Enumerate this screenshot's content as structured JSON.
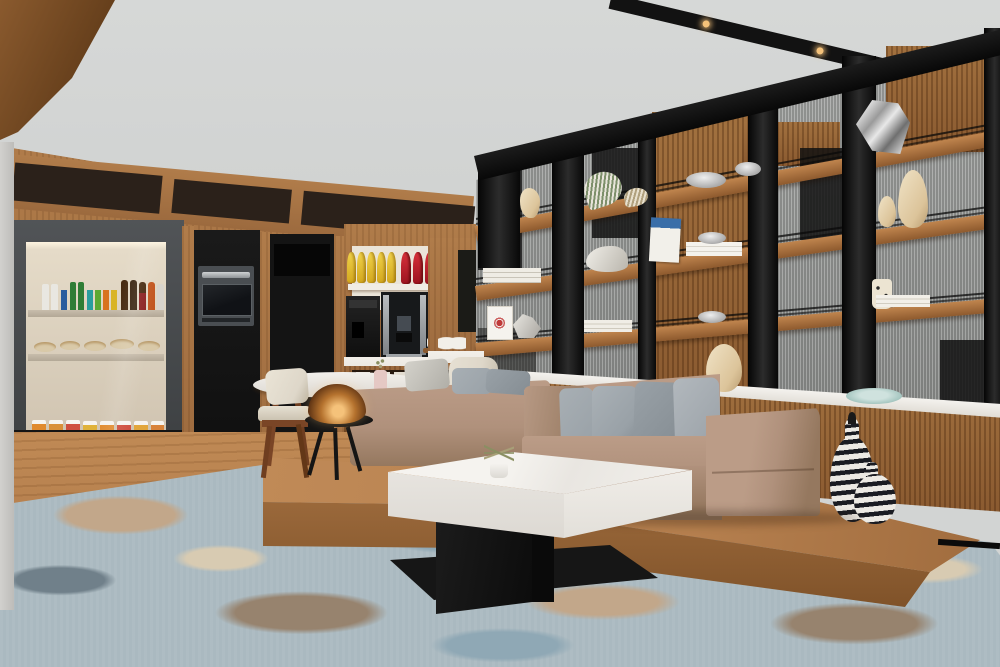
{
  "scene": {
    "title": "Hotel lounge pantry corner with snack display, coffee station, decorative shelving, tan sectional sofa, white marble coffee table and abstract blue rug",
    "room_type": "hotel lounge / pantry",
    "lighting": "soft daylight, warm recessed ceiling spots"
  },
  "palette": {
    "ceiling": "#d2d4d3",
    "beamBlack": "#121212",
    "lampGlow": "#f5c27a",
    "lampAmber": "#b5722e",
    "wood": "#9c6a3e",
    "woodLight": "#b07c4a",
    "woodDark": "#7a4e28",
    "woodSlat": "#a2713f",
    "woodSlatD": "#8a5a30",
    "floor": "#b07a4a",
    "floorLight": "#c08a55",
    "clerestory": "#2b211a",
    "panelBlack": "#141414",
    "caseFrame": "#46494b",
    "caseInner": "#d9cebd",
    "caseShelf": "#c7bcab",
    "counter": "#ece9e3",
    "marble": "#f1efeb",
    "marbleFace": "#e7e4df",
    "tableBlack": "#161616",
    "sofaTan": "#b0917c",
    "sofaTanDark": "#95785f",
    "pillow": "#99a1a7",
    "pillowDark": "#858d93",
    "cushionCream": "#ded7c9",
    "platform": "#b57f4e",
    "platformDark": "#9c6a3c",
    "rugBase": "#aab9c0",
    "rugBlue": "#8fa8b5",
    "rugSlate": "#70808a",
    "rugTan": "#c2a78a",
    "rugBrown": "#97836e",
    "rugCream": "#d8cbb2",
    "fluted": "#9fa19f",
    "chipsYellowL": "#f0d24a",
    "chipsYellow": "#d4a81e",
    "chipsRedL": "#d7303a",
    "chipsRed": "#9c1420",
    "snackGreen": "#7ea84a",
    "snackYellow": "#d9c23a",
    "snackBlue": "#2b72b8",
    "vaseCream": "#dcc49a",
    "vaseCreamL": "#f0e3c6",
    "stripeDark": "#1a1c22",
    "stripeLight": "#eceae4",
    "plateTeal": "#a5c6c0",
    "artRed": "#c03a3a",
    "plantGreen": "#8a8f62",
    "milkWhite": "#e9e7e1",
    "beerGreen": "#2f7d36",
    "beerBlue": "#2a5d9e",
    "beerRed": "#8a1f1f",
    "beerBrown": "#46290f",
    "canTeal": "#2a9d9e",
    "canOrange": "#d8721f",
    "canYellow": "#d9b425",
    "snackOrange": "#e08a2e",
    "snackRed2": "#cf4f3f",
    "bowlTan": "#d9c9a8",
    "pinkVase": "#e5c8c4"
  },
  "objects": [
    {
      "name": "snack-display-case",
      "desc": "recessed lit case with bottled drinks, snack bowls and to-go cups"
    },
    {
      "name": "wall-oven",
      "desc": "built-in stainless microwave oven in black cabinet"
    },
    {
      "name": "coffee-station",
      "desc": "bean-to-cup coffee machine and hot water dispenser with chip bags above"
    },
    {
      "name": "shelf-unit",
      "desc": "black steel and walnut display shelving with fluted glass back"
    },
    {
      "name": "decor",
      "desc": "ceramic vases, silver bowls, books, faceted metal sculpture, striped gourd vases"
    },
    {
      "name": "sofa",
      "desc": "tan leather sectional with gray linen pillows on walnut platform"
    },
    {
      "name": "coffee-table",
      "desc": "square white marble table on black plinth"
    },
    {
      "name": "side-lamp",
      "desc": "amber glass dome lamp on black tripod table"
    },
    {
      "name": "area-rug",
      "desc": "abstract blue, slate and tan hand-tufted rug"
    }
  ]
}
